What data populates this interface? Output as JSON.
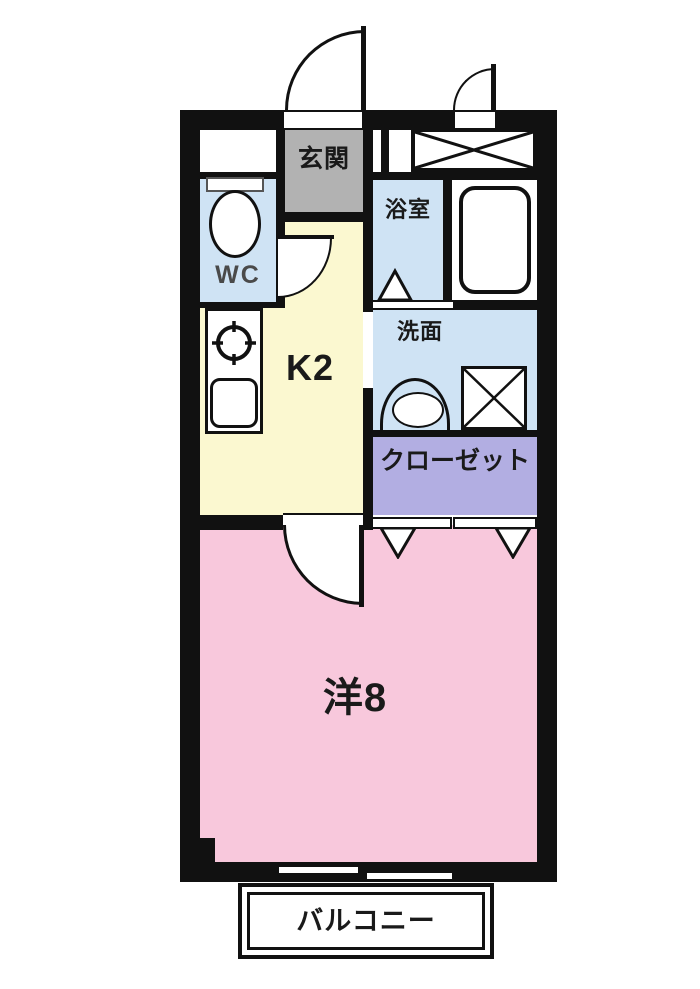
{
  "title": "1K apartment floor plan",
  "colors": {
    "wall": "#111111",
    "kitchen_floor": "#fbf8d0",
    "water_rooms_floor": "#cfe3f4",
    "genkan_floor": "#b2b2b2",
    "closet_floor": "#b2aee2",
    "main_room_floor": "#f8c8dc"
  },
  "rooms": {
    "genkan": {
      "label": "玄関"
    },
    "wc": {
      "label": "WC"
    },
    "bath": {
      "label": "浴室"
    },
    "kitchen": {
      "label": "K2"
    },
    "washroom": {
      "label": "洗面"
    },
    "closet": {
      "label": "クローゼット"
    },
    "main_room": {
      "label": "洋8"
    },
    "balcony": {
      "label": "バルコニー"
    }
  }
}
